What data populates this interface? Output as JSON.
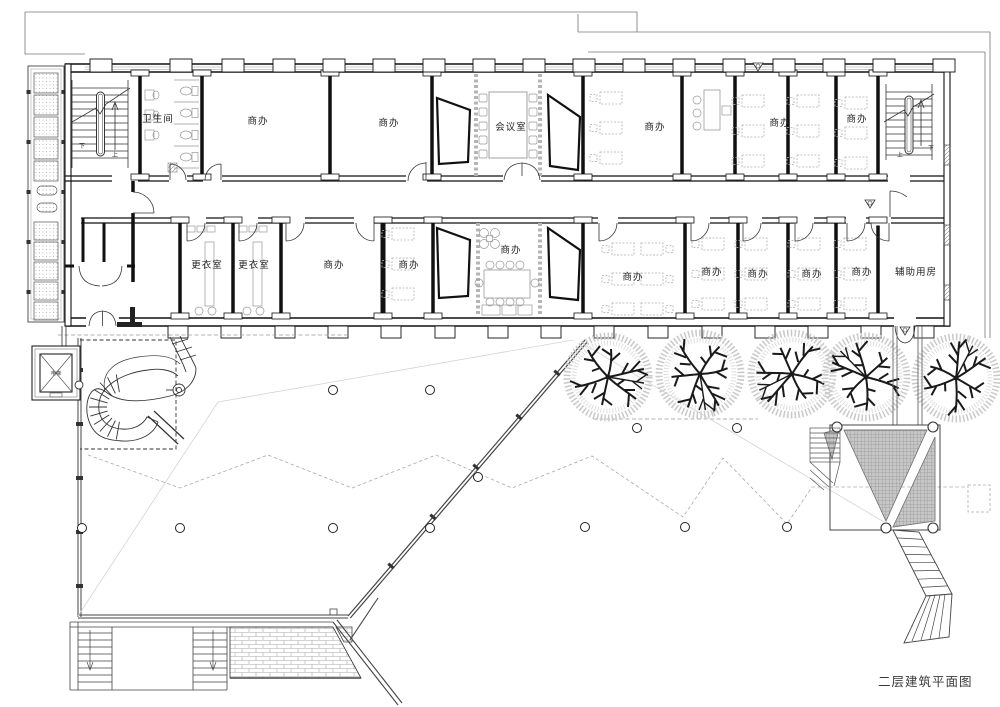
{
  "title": {
    "text": "二层建筑平面图"
  },
  "rooms": [
    {
      "label": "卫生间",
      "x": 158,
      "y": 122
    },
    {
      "label": "商办",
      "x": 258,
      "y": 124
    },
    {
      "label": "商办",
      "x": 389,
      "y": 126
    },
    {
      "label": "会议室",
      "x": 511,
      "y": 130
    },
    {
      "label": "商办",
      "x": 655,
      "y": 130
    },
    {
      "label": "商办",
      "x": 780,
      "y": 126
    },
    {
      "label": "商办",
      "x": 857,
      "y": 122
    },
    {
      "label": "更衣室",
      "x": 207,
      "y": 268
    },
    {
      "label": "更衣室",
      "x": 254,
      "y": 268
    },
    {
      "label": "商办",
      "x": 334,
      "y": 268
    },
    {
      "label": "商办",
      "x": 409,
      "y": 268
    },
    {
      "label": "商办",
      "x": 511,
      "y": 253
    },
    {
      "label": "商办",
      "x": 633,
      "y": 280
    },
    {
      "label": "商办",
      "x": 712,
      "y": 275
    },
    {
      "label": "商办",
      "x": 758,
      "y": 277
    },
    {
      "label": "商办",
      "x": 812,
      "y": 277
    },
    {
      "label": "商办",
      "x": 862,
      "y": 275
    },
    {
      "label": "辅助用房",
      "x": 916,
      "y": 275
    }
  ],
  "annotations": [
    {
      "text": "下",
      "x": 82,
      "y": 148
    },
    {
      "text": "上",
      "x": 115,
      "y": 157
    },
    {
      "text": "上",
      "x": 900,
      "y": 157
    },
    {
      "text": "下",
      "x": 931,
      "y": 150
    },
    {
      "text": "电梯",
      "x": 56,
      "y": 375
    }
  ],
  "trees": [
    {
      "x": 608,
      "y": 377
    },
    {
      "x": 700,
      "y": 374
    },
    {
      "x": 792,
      "y": 374
    },
    {
      "x": 866,
      "y": 377
    },
    {
      "x": 956,
      "y": 378
    }
  ],
  "terrace_columns": [
    [
      333,
      390
    ],
    [
      430,
      390
    ],
    [
      637,
      428
    ],
    [
      737,
      428
    ],
    [
      82,
      528
    ],
    [
      180,
      528
    ],
    [
      333,
      528
    ],
    [
      430,
      528
    ],
    [
      478,
      477
    ],
    [
      585,
      527
    ],
    [
      685,
      527
    ],
    [
      787,
      527
    ]
  ],
  "furniture": {
    "desk_clusters": [
      {
        "x": 600,
        "y": 92,
        "cols": 1,
        "rows": 3
      },
      {
        "x": 742,
        "y": 95,
        "cols": 1,
        "rows": 3
      },
      {
        "x": 797,
        "y": 95,
        "cols": 1,
        "rows": 3
      },
      {
        "x": 845,
        "y": 97,
        "cols": 1,
        "rows": 3
      },
      {
        "x": 392,
        "y": 228,
        "cols": 1,
        "rows": 3
      },
      {
        "x": 612,
        "y": 243,
        "cols": 2,
        "rows": 3
      },
      {
        "x": 702,
        "y": 238,
        "cols": 1,
        "rows": 3
      },
      {
        "x": 745,
        "y": 238,
        "cols": 1,
        "rows": 3
      },
      {
        "x": 798,
        "y": 238,
        "cols": 1,
        "rows": 3
      },
      {
        "x": 844,
        "y": 238,
        "cols": 1,
        "rows": 3
      }
    ]
  },
  "colors": {
    "line": "#1a1a1a",
    "light_line": "#999",
    "fill_gray": "#c7c7c7"
  }
}
